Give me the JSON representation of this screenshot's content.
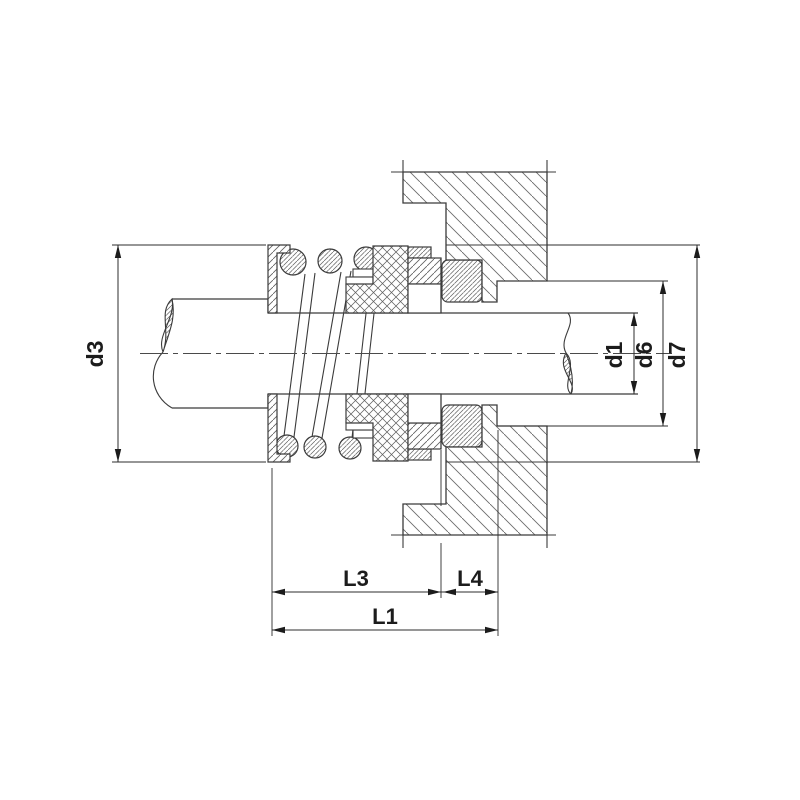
{
  "diagram": {
    "type": "engineering-section-drawing",
    "subject": "mechanical seal assembly cross-section on stepped shaft",
    "background": "#ffffff",
    "line_color": "#3b3b3b",
    "dimensions": {
      "d3": {
        "label": "d3",
        "orientation": "vertical",
        "side": "left"
      },
      "d1": {
        "label": "d1",
        "orientation": "vertical",
        "side": "right-inner"
      },
      "d6": {
        "label": "d6",
        "orientation": "vertical",
        "side": "right-middle"
      },
      "d7": {
        "label": "d7",
        "orientation": "vertical",
        "side": "right-outer"
      },
      "L3": {
        "label": "L3",
        "orientation": "horizontal",
        "side": "bottom-upper"
      },
      "L4": {
        "label": "L4",
        "orientation": "horizontal",
        "side": "bottom-upper"
      },
      "L1": {
        "label": "L1",
        "orientation": "horizontal",
        "side": "bottom-lower"
      }
    },
    "parts": [
      "shaft",
      "shaft-shoulder",
      "spring-retainer",
      "coil-spring",
      "drive-band",
      "elastomer-bellows",
      "rotating-seal-ring",
      "stationary-seat",
      "gland-plate",
      "housing"
    ]
  }
}
